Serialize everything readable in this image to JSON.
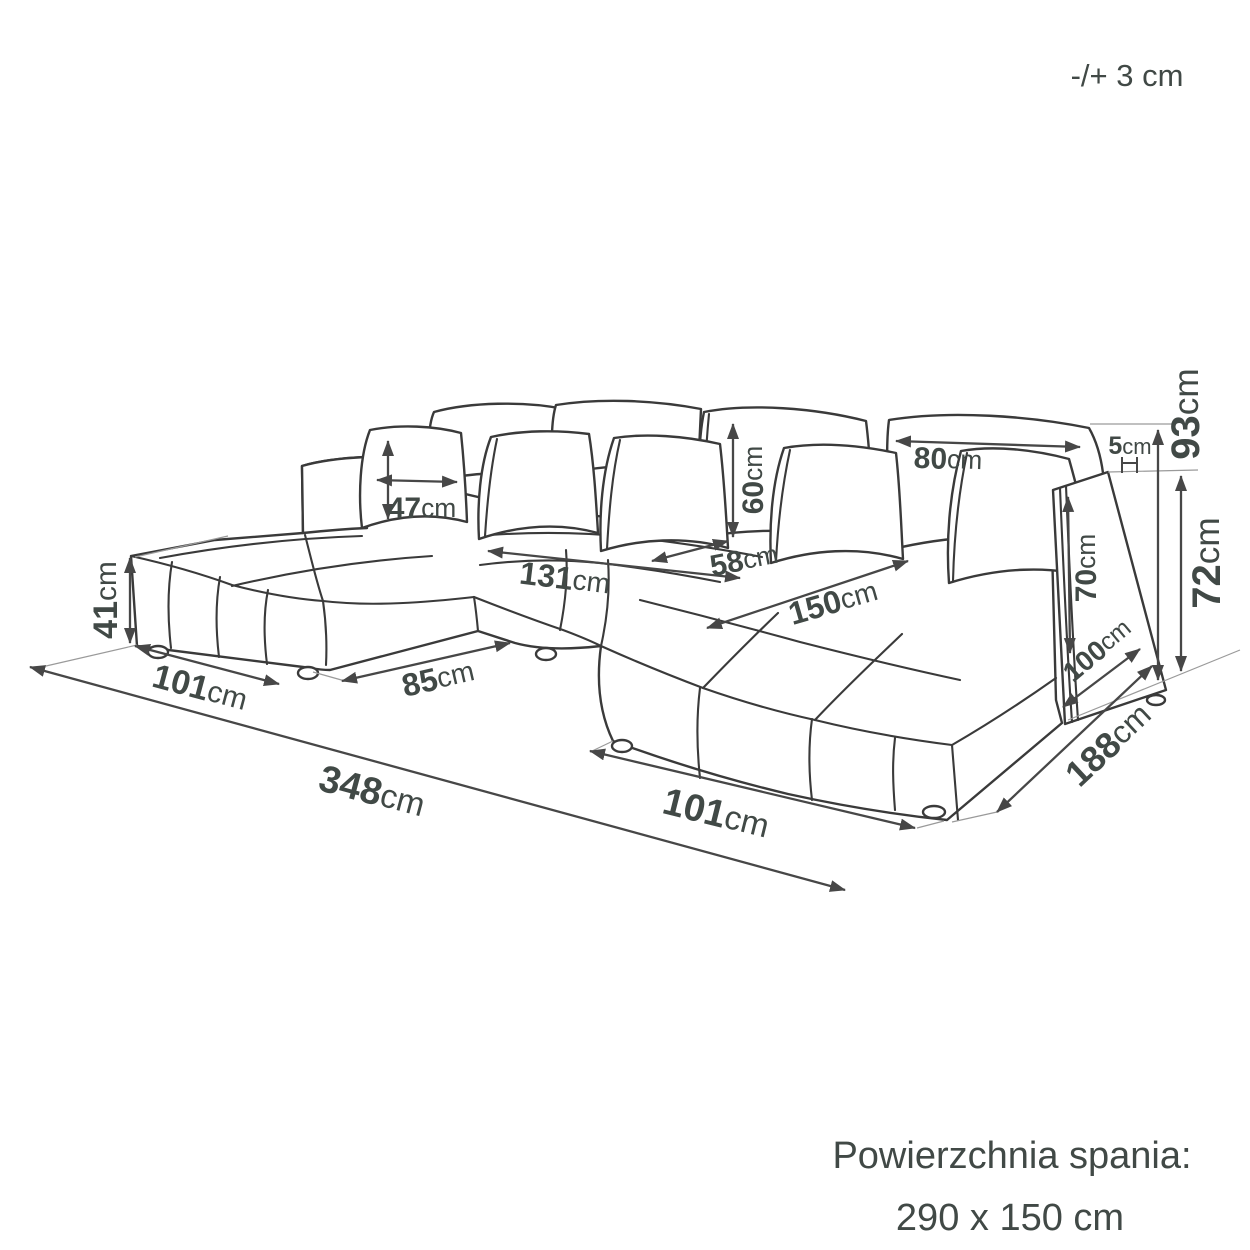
{
  "figure": {
    "tolerance_note": "-/+ 3 cm",
    "sleeping_surface_label": "Powierzchnia spania:",
    "sleeping_surface_size": "290 x 150 cm"
  },
  "dimensions": {
    "pillow_width": {
      "value": "47",
      "unit": "cm"
    },
    "back_cushion_height": {
      "value": "60",
      "unit": "cm"
    },
    "back_cushion_width": {
      "value": "80",
      "unit": "cm"
    },
    "back_gap": {
      "value": "5",
      "unit": "cm"
    },
    "total_height": {
      "value": "93",
      "unit": "cm"
    },
    "side_height": {
      "value": "72",
      "unit": "cm"
    },
    "armrest_height": {
      "value": "70",
      "unit": "cm"
    },
    "armrest_depth": {
      "value": "100",
      "unit": "cm"
    },
    "seat_height": {
      "value": "41",
      "unit": "cm"
    },
    "left_chaise_width": {
      "value": "101",
      "unit": "cm"
    },
    "middle_front_width": {
      "value": "85",
      "unit": "cm"
    },
    "middle_seat_width": {
      "value": "131",
      "unit": "cm"
    },
    "seat_depth": {
      "value": "58",
      "unit": "cm"
    },
    "right_chaise_length": {
      "value": "150",
      "unit": "cm"
    },
    "total_width": {
      "value": "348",
      "unit": "cm"
    },
    "right_chaise_width": {
      "value": "101",
      "unit": "cm"
    },
    "total_depth": {
      "value": "188",
      "unit": "cm"
    }
  }
}
